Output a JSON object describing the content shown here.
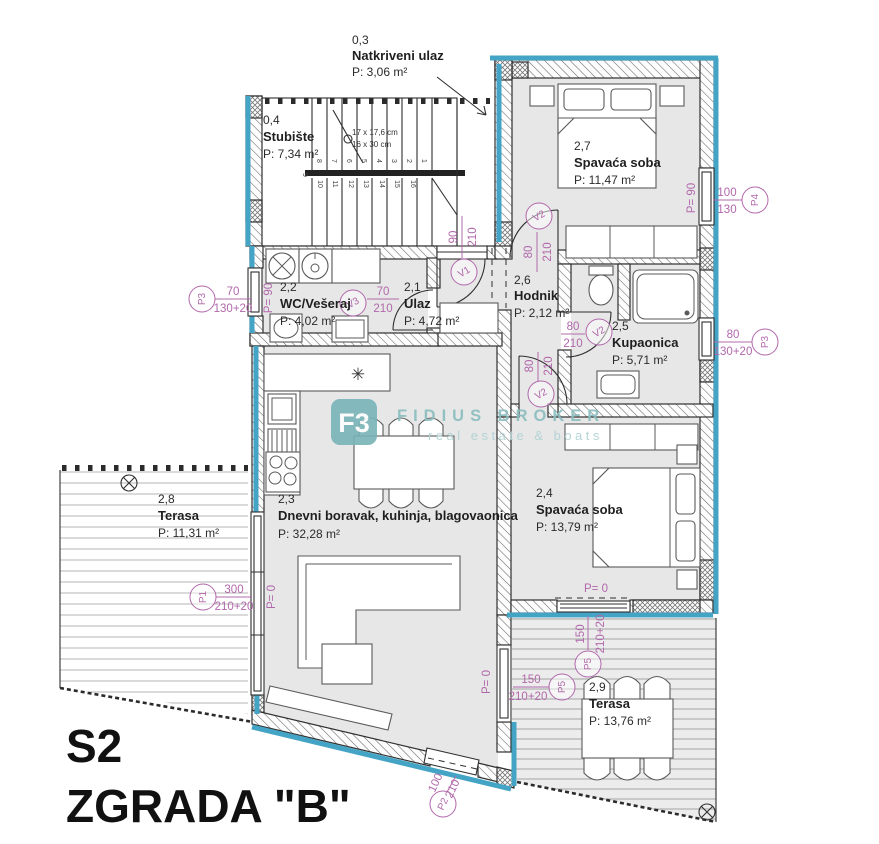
{
  "plan": {
    "unit": "S2",
    "building": "ZGRADA \"B\""
  },
  "colors": {
    "insulation": "#44a4c5",
    "dimension": "#b168ab",
    "wall_line": "#2f2f2f",
    "room_fill": "#e7e7e7",
    "watermark": "#8abdbf"
  },
  "rooms": {
    "r03": {
      "num": "0,3",
      "name": "Natkriveni ulaz",
      "area": "P: 3,06 m²"
    },
    "r04": {
      "num": "0,4",
      "name": "Stubište",
      "area": "P: 7,34 m²"
    },
    "r21": {
      "num": "2,1",
      "name": "Ulaz",
      "area": "P: 4,72 m²"
    },
    "r22": {
      "num": "2,2",
      "name": "WC/Vešeraj",
      "area": "P: 4,02 m²"
    },
    "r23": {
      "num": "2,3",
      "name": "Dnevni boravak, kuhinja, blagovaonica",
      "area": "P: 32,28 m²"
    },
    "r24": {
      "num": "2,4",
      "name": "Spavaća soba",
      "area": "P: 13,79 m²"
    },
    "r25": {
      "num": "2,5",
      "name": "Kupaonica",
      "area": "P: 5,71 m²"
    },
    "r26": {
      "num": "2,6",
      "name": "Hodnik",
      "area": "P: 2,12 m²"
    },
    "r27": {
      "num": "2,7",
      "name": "Spavaća soba",
      "area": "P: 11,47 m²"
    },
    "r28": {
      "num": "2,8",
      "name": "Terasa",
      "area": "P: 11,31 m²"
    },
    "r29": {
      "num": "2,9",
      "name": "Terasa",
      "area": "P: 13,76 m²"
    }
  },
  "openings": {
    "v1": {
      "id": "V1",
      "w": "90",
      "h": "210"
    },
    "v2_bedroom27": {
      "id": "V2",
      "w": "80",
      "h": "210"
    },
    "v2_bathroom": {
      "id": "V2",
      "w": "80",
      "h": "210"
    },
    "v2_bedroom24": {
      "id": "V2",
      "w": "80",
      "h": "210"
    },
    "v3": {
      "id": "V3",
      "w": "70",
      "h": "210"
    },
    "p1": {
      "id": "P1",
      "w": "300",
      "h": "210+20"
    },
    "p2": {
      "id": "P2",
      "w": "100",
      "h": "210"
    },
    "p3_left": {
      "id": "P3",
      "w": "70",
      "h": "130+20"
    },
    "p3_right": {
      "id": "P3",
      "w": "80",
      "h": "130+20"
    },
    "p4": {
      "id": "P4",
      "w": "100",
      "h": "130"
    },
    "p5_south": {
      "id": "P5",
      "w": "150",
      "h": "210+20"
    },
    "p5_west": {
      "id": "P5",
      "w": "150",
      "h": "210+20"
    }
  },
  "levels": {
    "p90": "P= 90",
    "p0": "P= 0"
  },
  "stairs": {
    "riser": "17 x 17,6 cm",
    "tread": "16 x 30 cm",
    "steps": [
      "1",
      "2",
      "3",
      "4",
      "5",
      "6",
      "7",
      "8",
      "9",
      "10",
      "11",
      "12",
      "13",
      "14",
      "15",
      "16"
    ]
  },
  "symbols": {
    "hob": "✳"
  },
  "watermark": {
    "logo": "F3",
    "name": "FIDIUS BROKER",
    "tagline": "real estate & boats"
  }
}
